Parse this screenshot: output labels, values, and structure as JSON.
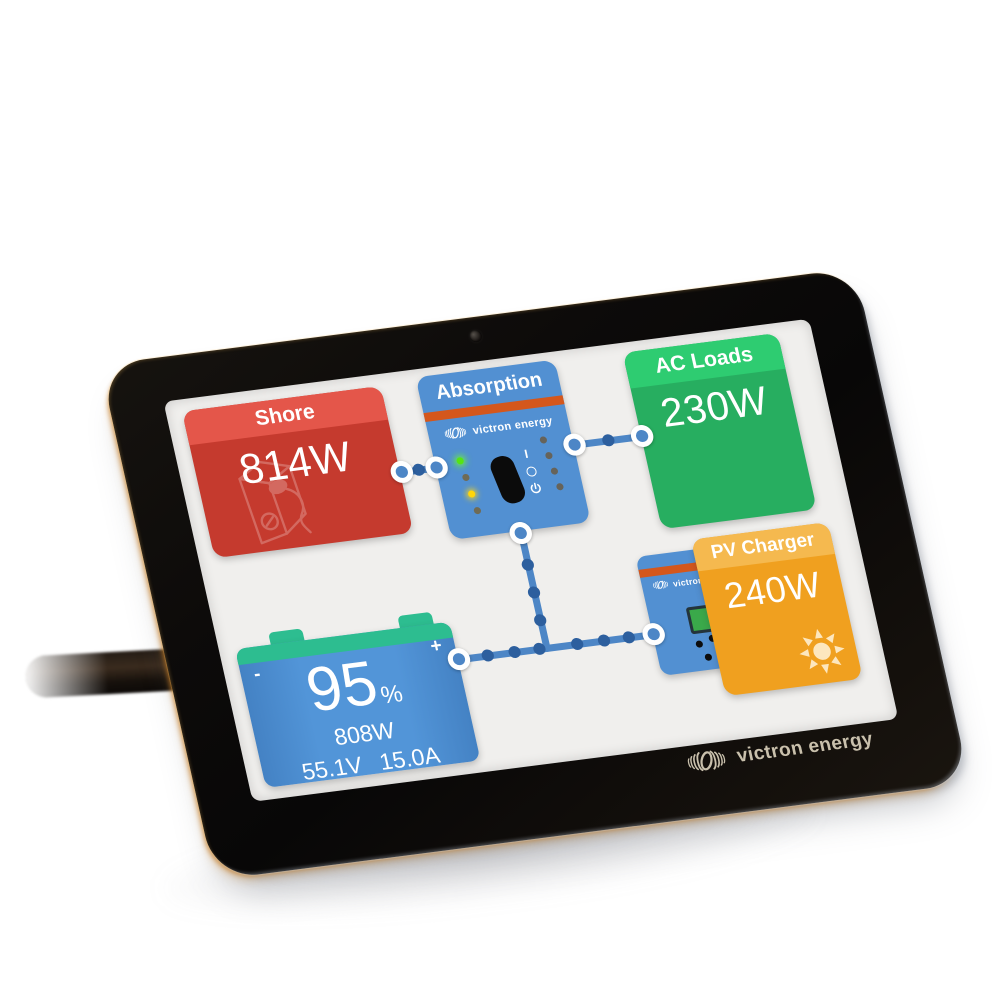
{
  "device": {
    "bezel_brand": "victron energy"
  },
  "screen": {
    "shore": {
      "label": "Shore",
      "value": "814W"
    },
    "inverter": {
      "title": "Absorption",
      "brand": "victron energy",
      "switch_label": "I",
      "leds_left": [
        "green",
        "off",
        "yellow",
        "off"
      ],
      "leds_right": [
        "off",
        "off",
        "off",
        "off"
      ]
    },
    "ac_loads": {
      "label": "AC Loads",
      "value": "230W"
    },
    "pv_charger": {
      "label": "PV Charger",
      "value": "240W"
    },
    "mppt": {
      "brand": "victron energy"
    },
    "battery": {
      "soc": "95",
      "soc_unit": "%",
      "power": "808W",
      "voltage": "55.1V",
      "current": "15.0A",
      "minus": "-",
      "plus": "+"
    }
  },
  "connections": [
    {
      "from": "shore",
      "to": "inverter"
    },
    {
      "from": "inverter",
      "to": "ac-loads"
    },
    {
      "from": "inverter",
      "to": "dc-bus"
    },
    {
      "from": "battery",
      "to": "dc-bus"
    },
    {
      "from": "pv-charger",
      "to": "dc-bus"
    }
  ],
  "colors": {
    "shore_red": "#c53a2e",
    "shore_red_band": "#e4564a",
    "ac_green": "#27ae60",
    "ac_green_band": "#2ecc71",
    "pv_orange": "#f0a01f",
    "pv_orange_band": "#f5b94f",
    "victron_blue": "#5290d2",
    "stripe_orange": "#d4571c",
    "battery_green_bar": "#2dbd90",
    "flow_line_blue": "#4d86c6",
    "flow_bead_blue": "#2d5f9e",
    "screen_bg": "#f0efed"
  }
}
